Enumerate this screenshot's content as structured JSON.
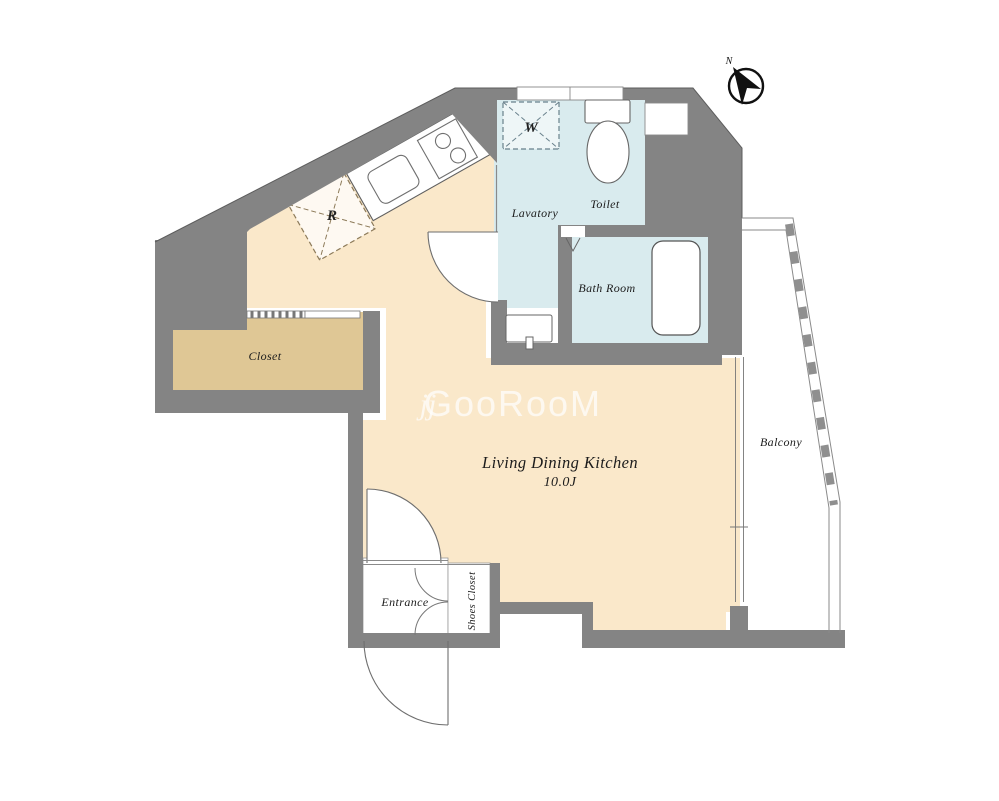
{
  "plan": {
    "watermark": {
      "logo": "jj",
      "text": "GooRooM"
    },
    "compass": {
      "label": "N"
    },
    "rooms": {
      "ldk": {
        "label": "Living Dining Kitchen",
        "size": "10.0J"
      },
      "lavatory": {
        "label": "Lavatory"
      },
      "toilet": {
        "label": "Toilet"
      },
      "bathroom": {
        "label": "Bath Room"
      },
      "closet": {
        "label": "Closet"
      },
      "entrance": {
        "label": "Entrance"
      },
      "shoes_closet": {
        "label": "Shoes Closet"
      },
      "balcony": {
        "label": "Balcony"
      }
    },
    "fixtures": {
      "washer": "W",
      "refrigerator": "R"
    },
    "colors": {
      "wall": "#848484",
      "ldk_floor": "#FAE8CA",
      "wet_floor": "#D9EBEE",
      "closet_floor": "#DFC795"
    }
  }
}
